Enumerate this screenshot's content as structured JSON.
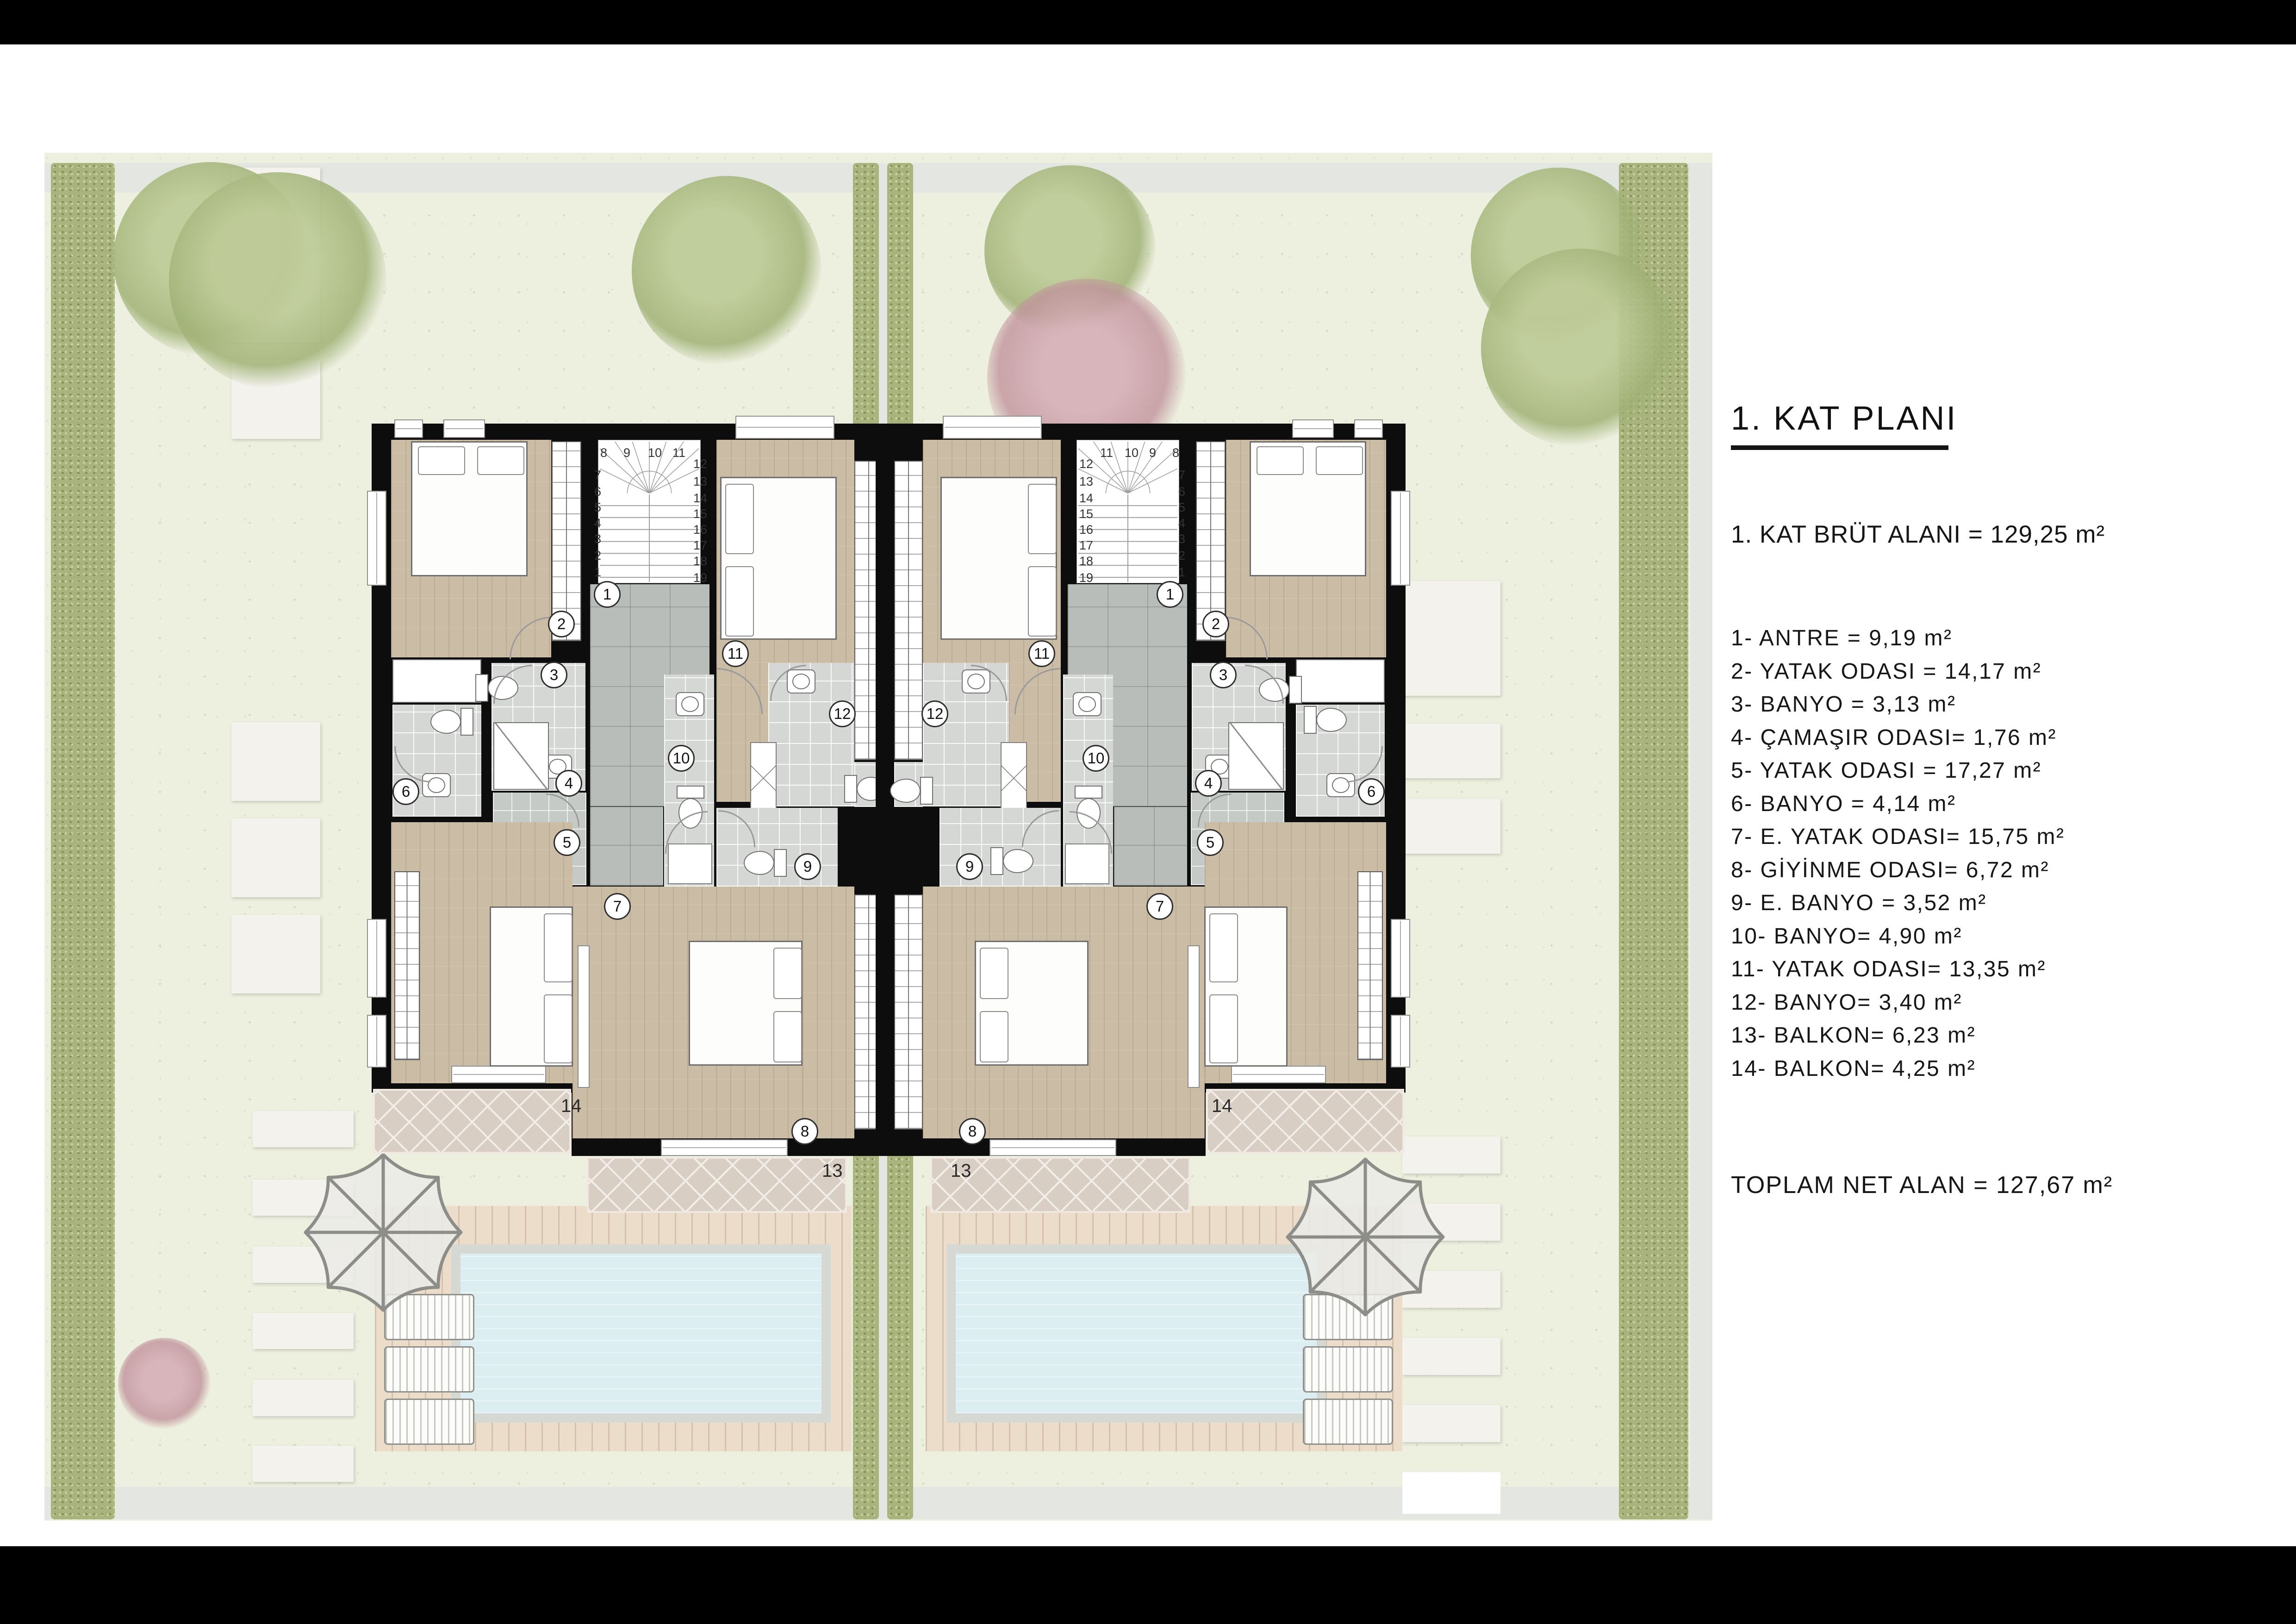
{
  "sheet": {
    "title_block": {
      "title": "1. KAT PLANI",
      "area_line": "1. KAT BRÜT ALANI = 129,25 m²",
      "rooms": [
        "1- ANTRE = 9,19 m²",
        "2- YATAK ODASI = 14,17 m²",
        "3- BANYO = 3,13 m²",
        "4- ÇAMAŞIR ODASI= 1,76 m²",
        "5- YATAK ODASI = 17,27 m²",
        "6- BANYO = 4,14 m²",
        "7- E. YATAK ODASI= 15,75 m²",
        "8- GİYİNME ODASI= 6,72 m²",
        "9- E. BANYO = 3,52 m²",
        "10- BANYO= 4,90 m²",
        "11- YATAK ODASI= 13,35 m²",
        "12- BANYO= 3,40 m²",
        "13- BALKON= 6,23 m²",
        "14- BALKON= 4,25 m²"
      ],
      "total_line": "TOPLAM NET ALAN = 127,67 m²"
    },
    "plan": {
      "room_numbers": [
        "1",
        "2",
        "3",
        "4",
        "5",
        "6",
        "7",
        "8",
        "9",
        "10",
        "11",
        "12",
        "13",
        "14"
      ],
      "plain_numbers": [
        "13",
        "14"
      ],
      "stair_top_row": [
        "8",
        "9",
        "10",
        "11"
      ],
      "stair_left_col": [
        "7",
        "6",
        "5",
        "4",
        "3",
        "2",
        "1"
      ],
      "stair_right_col": [
        "12",
        "13",
        "14",
        "15",
        "16",
        "17",
        "18",
        "19"
      ],
      "units": 2
    },
    "colors": {
      "wall": "#0d0d0d",
      "wood_floor": "#cbbca5",
      "entry_tile": "#b9bdb9",
      "bath_tile": "#d4d7d4",
      "balcony_tile": "#d9cec3",
      "pool_water": "#dceef1",
      "deck_wood": "#ecddcb",
      "site_green": "#edefdf",
      "hedge_green": "#a9b47c"
    }
  }
}
